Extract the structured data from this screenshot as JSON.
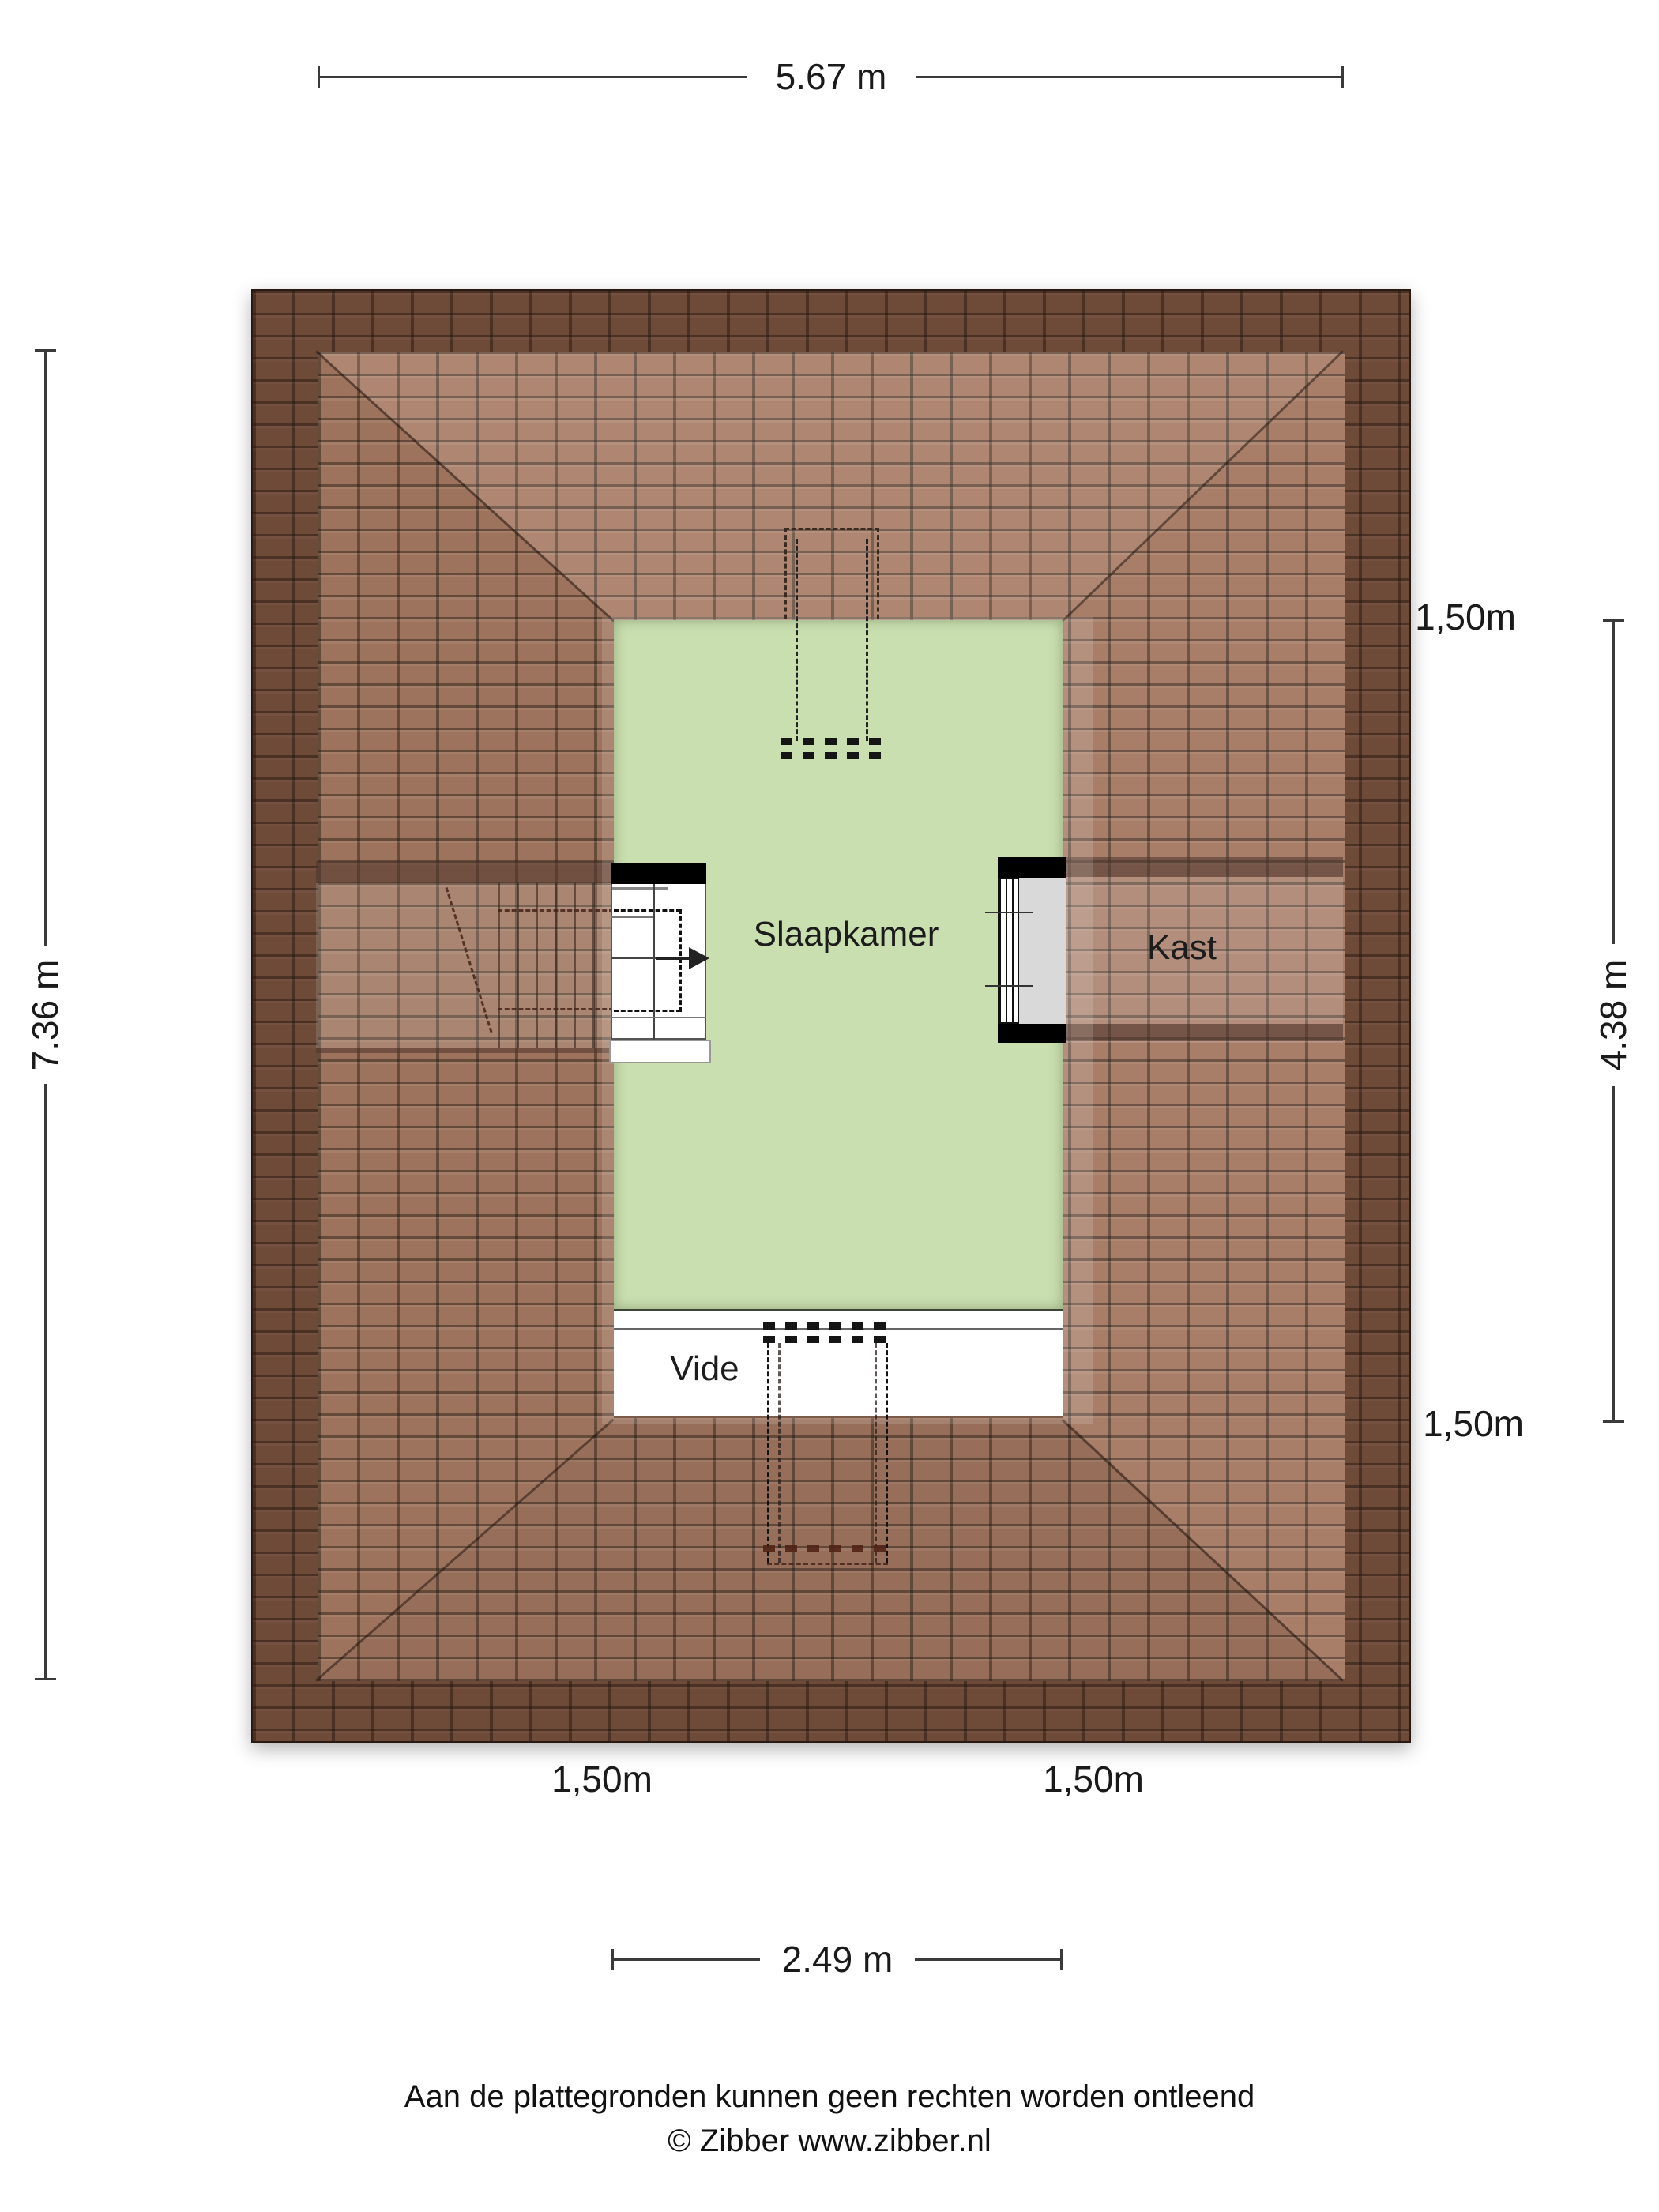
{
  "rooms": {
    "slaapkamer": "Slaapkamer",
    "kast": "Kast",
    "vide": "Vide"
  },
  "dimensions": {
    "top": "5.67 m",
    "left": "7.36 m",
    "right": "4.38 m",
    "bottom": "2.49 m"
  },
  "contour_labels": {
    "right_top": "1,50m",
    "right_bottom": "1,50m",
    "bottom_left": "1,50m",
    "bottom_right": "1,50m"
  },
  "footer": {
    "disclaimer": "Aan de plattegronden kunnen geen rechten worden ontleend",
    "copyright": "© Zibber www.zibber.nl"
  },
  "colors": {
    "page_bg": "#ffffff",
    "roof_base": "#9e7159",
    "roof_eave_shade": "#5e3c2f",
    "room_green": "#cadfb0",
    "kast_gray": "#d9d9d9",
    "wall_black": "#000000",
    "line_dark": "#3a3a3a"
  }
}
